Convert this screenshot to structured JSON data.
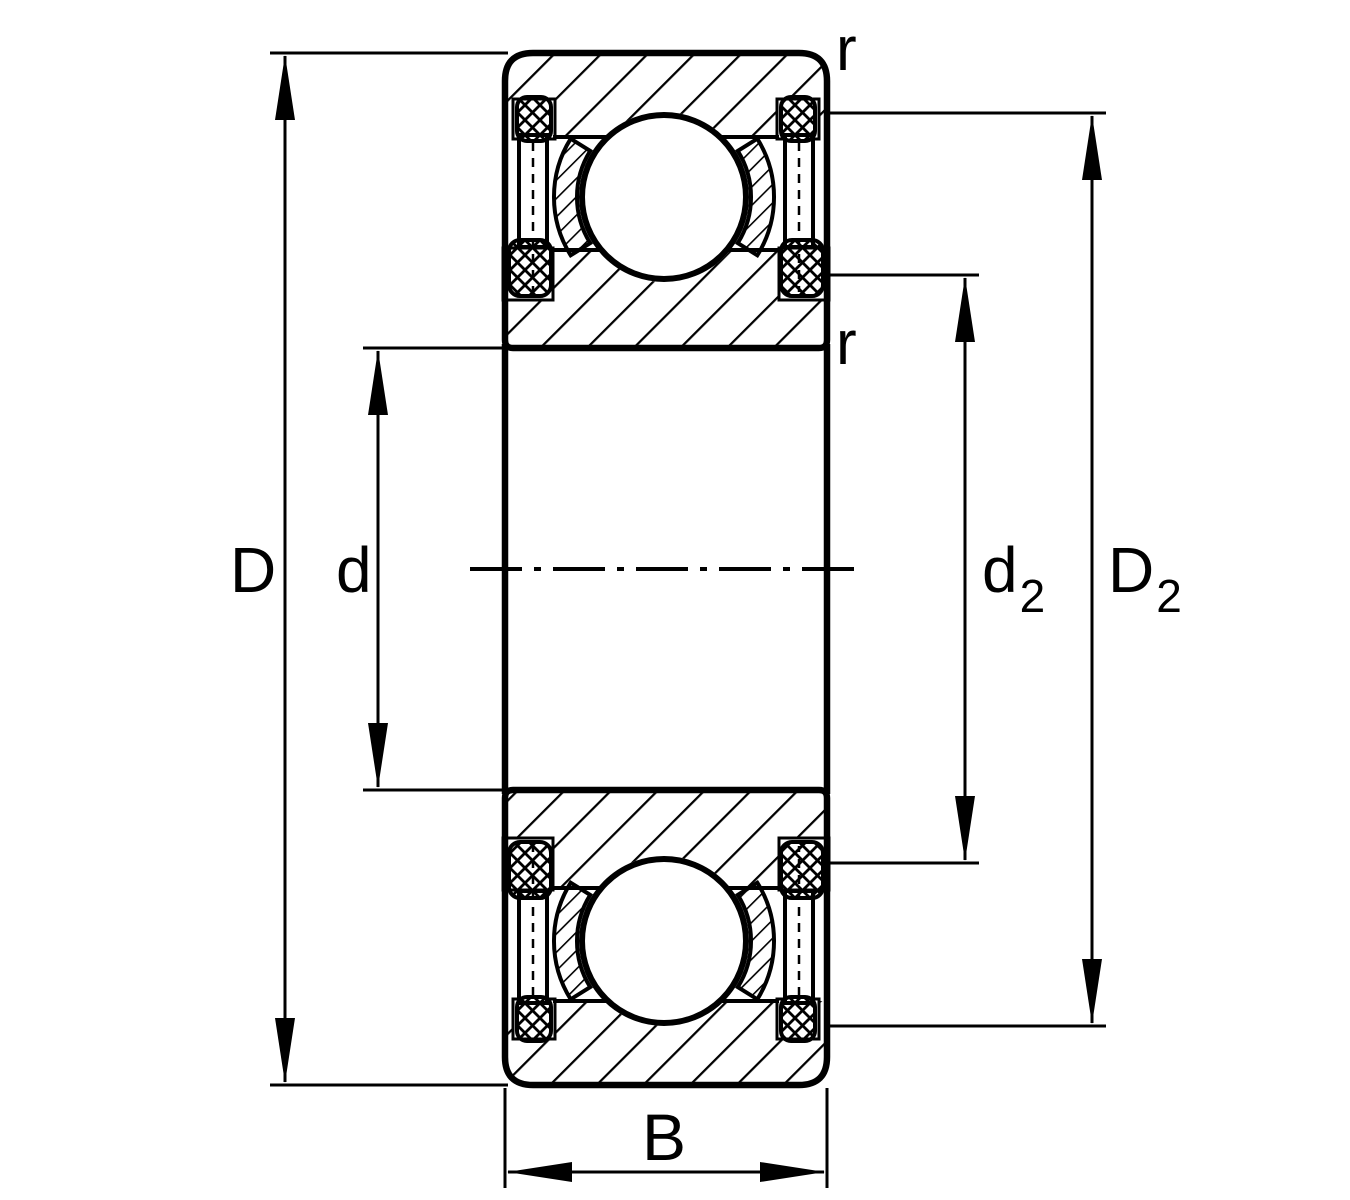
{
  "drawing": {
    "title": "Sealed deep groove ball bearing cross-section",
    "labels": {
      "outer_diameter": "D",
      "bore_diameter": "d",
      "inner_recess_main": "d",
      "inner_recess_sub": "2",
      "outer_recess_main": "D",
      "outer_recess_sub": "2",
      "width": "B",
      "chamfer_outer": "r",
      "chamfer_inner": "r"
    },
    "colors": {
      "line": "#000000",
      "background": "#ffffff"
    }
  }
}
